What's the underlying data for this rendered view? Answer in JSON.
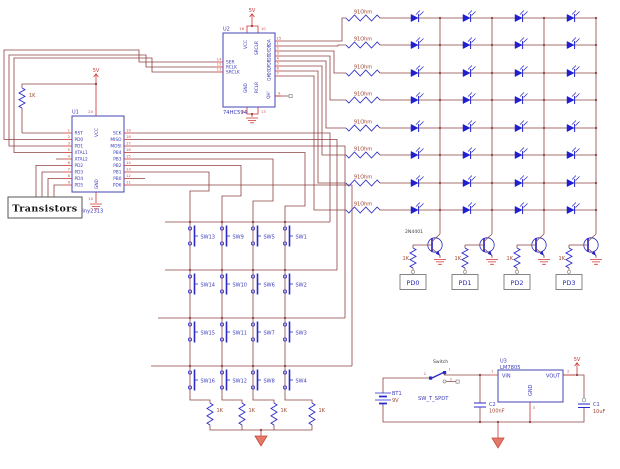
{
  "schematic": {
    "u1": {
      "ref": "U1",
      "part": "ATtiny2313",
      "vcc": {
        "name": "VCC",
        "num": "20"
      },
      "gnd": {
        "name": "GND",
        "num": "10"
      },
      "left_pins": [
        {
          "name": "RST",
          "num": "1"
        },
        {
          "name": "PD0",
          "num": "2"
        },
        {
          "name": "PD1",
          "num": "3"
        },
        {
          "name": "XTAL1",
          "num": "5"
        },
        {
          "name": "XTAL2",
          "num": "4"
        },
        {
          "name": "PD2",
          "num": "6"
        },
        {
          "name": "PD3",
          "num": "7"
        },
        {
          "name": "PD4",
          "num": "8"
        },
        {
          "name": "PD5",
          "num": "9"
        }
      ],
      "right_pins": [
        {
          "name": "SCK",
          "num": "19"
        },
        {
          "name": "MISO",
          "num": "18"
        },
        {
          "name": "MOSI",
          "num": "17"
        },
        {
          "name": "PB4",
          "num": "16"
        },
        {
          "name": "PB3",
          "num": "15"
        },
        {
          "name": "PB2",
          "num": "14"
        },
        {
          "name": "PB1",
          "num": "13"
        },
        {
          "name": "PB0",
          "num": "12"
        },
        {
          "name": "PD6",
          "num": "11"
        }
      ],
      "pullup_value": "1K"
    },
    "u2": {
      "ref": "U2",
      "part": "74HC594",
      "left_pins": [
        {
          "name": "SER",
          "num": "14"
        },
        {
          "name": "RCLK",
          "num": "12"
        },
        {
          "name": "SRCLK",
          "num": "11"
        }
      ],
      "right_pins": [
        {
          "name": "QA",
          "num": "15"
        },
        {
          "name": "QB",
          "num": "1"
        },
        {
          "name": "QC",
          "num": "2"
        },
        {
          "name": "QD",
          "num": "3"
        },
        {
          "name": "QE",
          "num": "4"
        },
        {
          "name": "QF",
          "num": "5"
        },
        {
          "name": "QG",
          "num": "6"
        },
        {
          "name": "QH",
          "num": "7"
        }
      ],
      "qh_out": {
        "name": "QH'",
        "num": "9"
      },
      "top_pins": [
        {
          "name": "VCC",
          "num": "16"
        },
        {
          "name": "SRCLR",
          "num": "10"
        }
      ],
      "bottom_pins": [
        {
          "name": "GND",
          "num": "8"
        },
        {
          "name": "RCLR",
          "num": "13"
        }
      ]
    },
    "power_flag_label": "5V",
    "led_matrix": {
      "rows": 8,
      "cols": 4,
      "row_resistor_value": "91Ohm"
    },
    "drivers": {
      "transistor_part": "2N4401",
      "base_resistor_value": "1K",
      "ports": [
        "PD0",
        "PD1",
        "PD2",
        "PD3"
      ]
    },
    "switch_matrix": {
      "rows": [
        [
          "SW13",
          "SW9",
          "SW5",
          "SW1"
        ],
        [
          "SW14",
          "SW10",
          "SW6",
          "SW2"
        ],
        [
          "SW15",
          "SW11",
          "SW7",
          "SW3"
        ],
        [
          "SW16",
          "SW12",
          "SW8",
          "SW4"
        ]
      ],
      "pulldown_value": "1K"
    },
    "transistors_label": "Transistors",
    "power": {
      "battery": {
        "ref": "BT1",
        "value": "9V"
      },
      "switch": {
        "label": "Switch",
        "part": "SW_T_SPDT",
        "pin_common": "2",
        "pin_no": "1",
        "pin_nc": "3"
      },
      "u3": {
        "ref": "U3",
        "part": "LM7805",
        "vin": {
          "name": "VIN",
          "num": "1"
        },
        "vout": {
          "name": "VOUT",
          "num": "2"
        },
        "gnd": {
          "name": "GND",
          "num": "3"
        }
      },
      "c2": {
        "ref": "C2",
        "value": "100nF"
      },
      "c1": {
        "ref": "C1",
        "value": "10uF"
      }
    }
  }
}
